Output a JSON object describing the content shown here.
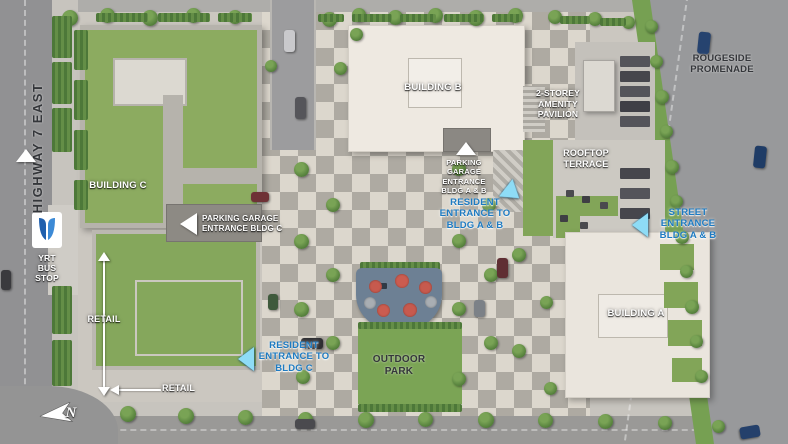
{
  "title": "Condominium development site plan",
  "roads": {
    "highway_label": "HIGHWAY 7 EAST",
    "rougeside_label": "ROUGESIDE\nPROMENADE"
  },
  "transit": {
    "yrt_stop_label": "YRT\nBUS\nSTOP",
    "yrt_logo": "yrt-transit-logo"
  },
  "buildings": {
    "a": "BUILDING A",
    "b": "BUILDING B",
    "c": "BUILDING C"
  },
  "entrances": {
    "parking_c": "PARKING GARAGE\nENTRANCE BLDG C",
    "parking_ab": "PARKING\nGARAGE\nENTRANCE\nBLDG A & B",
    "resident_ab": "RESIDENT\nENTRANCE TO\nBLDG A & B",
    "resident_c": "RESIDENT\nENTRANCE TO\nBLDG C",
    "street_ab": "STREET\nENTRANCE\nBLDG A & B"
  },
  "amenities": {
    "pavilion": "2-STOREY\nAMENITY\nPAVILION",
    "rooftop": "ROOFTOP\nTERRACE",
    "outdoor_park": "OUTDOOR\nPARK",
    "retail_west": "RETAIL",
    "retail_south": "RETAIL"
  },
  "compass": {
    "north": "N"
  },
  "colors": {
    "road": "#919193",
    "plaza_light": "#dcd7cd",
    "plaza_dark": "#aeaaa2",
    "grass": "#82a558",
    "building_roof": "#eee9e1",
    "green_roof": "#8cab60",
    "label_blue": "#1e7bc2",
    "arrow_cyan": "#8edcf6",
    "playground_pad": "#6d8094",
    "playground_red": "#c75a4e",
    "yrt_blue_dark": "#1e5fae",
    "yrt_blue_light": "#3c8ad6"
  }
}
